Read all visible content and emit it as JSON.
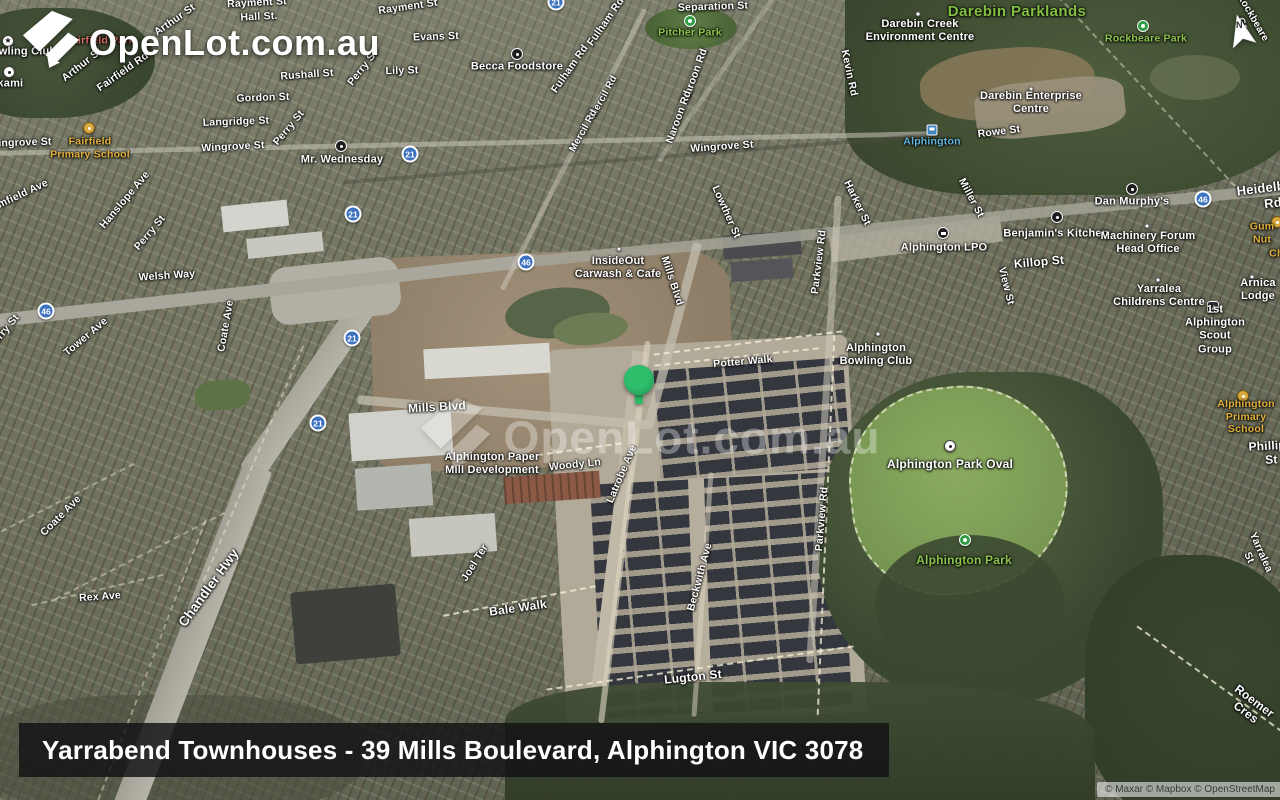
{
  "brand": {
    "logo_text": "OpenLot.com.au"
  },
  "watermark": {
    "text": "OpenLot.com.au"
  },
  "caption": {
    "text": "Yarrabend Townhouses - 39 Mills Boulevard, Alphington VIC 3078"
  },
  "attribution": {
    "text": "© Maxar © Mapbox © OpenStreetMap"
  },
  "compass": {
    "letter": "N"
  },
  "marker": {
    "label": "property-location",
    "x": 640,
    "y": 380,
    "color": "#2ebd6b"
  },
  "colors": {
    "shield_blue": "#3c72bf",
    "park_label_green": "#8cc44c",
    "school_label_amber": "#e3b23e",
    "station_label_blue": "#63b5e0",
    "area_label_red": "#e2756b",
    "pin_green": "#2ebd6b"
  },
  "map": {
    "shields": [
      {
        "n": "21",
        "x": 556,
        "y": 2
      },
      {
        "n": "21",
        "x": 410,
        "y": 154
      },
      {
        "n": "21",
        "x": 353,
        "y": 214
      },
      {
        "n": "21",
        "x": 352,
        "y": 338
      },
      {
        "n": "21",
        "x": 318,
        "y": 423
      },
      {
        "n": "46",
        "x": 46,
        "y": 311
      },
      {
        "n": "46",
        "x": 526,
        "y": 262
      },
      {
        "n": "46",
        "x": 1203,
        "y": 199
      }
    ],
    "markers": [
      {
        "type": "park",
        "x": 690,
        "y": 21
      },
      {
        "type": "park",
        "x": 1143,
        "y": 26
      },
      {
        "type": "park",
        "x": 965,
        "y": 540
      },
      {
        "type": "school",
        "x": 89,
        "y": 128
      },
      {
        "type": "school",
        "x": 1243,
        "y": 396
      },
      {
        "type": "school",
        "x": 1277,
        "y": 222
      },
      {
        "type": "poi-black",
        "x": 517,
        "y": 54
      },
      {
        "type": "poi-black",
        "x": 341,
        "y": 146
      },
      {
        "type": "poi-black",
        "x": 1132,
        "y": 189
      },
      {
        "type": "poi-black",
        "x": 1057,
        "y": 217
      },
      {
        "type": "poi-post",
        "x": 943,
        "y": 233
      },
      {
        "type": "dot",
        "x": 619,
        "y": 249
      },
      {
        "type": "star",
        "x": 8,
        "y": 41
      },
      {
        "type": "poi-white",
        "x": 9,
        "y": 72
      },
      {
        "type": "dot",
        "x": 918,
        "y": 14
      },
      {
        "type": "dot",
        "x": 1031,
        "y": 89
      },
      {
        "type": "dot",
        "x": 1147,
        "y": 226
      },
      {
        "type": "dot",
        "x": 1158,
        "y": 280
      },
      {
        "type": "dot",
        "x": 1252,
        "y": 277
      },
      {
        "type": "dot",
        "x": 878,
        "y": 334
      },
      {
        "type": "rail",
        "x": 932,
        "y": 130
      },
      {
        "type": "scout",
        "x": 1213,
        "y": 307
      },
      {
        "type": "poi-white",
        "x": 950,
        "y": 446
      }
    ],
    "labels": [
      {
        "t": "Rayment St",
        "x": 257,
        "y": 3,
        "r": -3
      },
      {
        "t": "Hall St.",
        "x": 259,
        "y": 17,
        "r": -3
      },
      {
        "t": "Rayment St",
        "x": 408,
        "y": 7,
        "r": -8
      },
      {
        "t": "Evans St",
        "x": 436,
        "y": 37,
        "r": -2
      },
      {
        "t": "Lily St",
        "x": 402,
        "y": 71,
        "r": -2
      },
      {
        "t": "Rushall St",
        "x": 307,
        "y": 75,
        "r": -4
      },
      {
        "t": "Perry St",
        "x": 363,
        "y": 68,
        "r": -52
      },
      {
        "t": "Arthur St",
        "x": 175,
        "y": 20,
        "r": -35
      },
      {
        "t": "Arthur St",
        "x": 82,
        "y": 65,
        "r": -38
      },
      {
        "t": "Fairfield Rd",
        "x": 123,
        "y": 72,
        "r": -35
      },
      {
        "t": "Separation St",
        "x": 713,
        "y": 7,
        "r": -2
      },
      {
        "t": "Gordon St",
        "x": 263,
        "y": 98,
        "r": -2
      },
      {
        "t": "Langridge St",
        "x": 236,
        "y": 122,
        "r": -2
      },
      {
        "t": "Wingrove St",
        "x": 20,
        "y": 143,
        "r": -2
      },
      {
        "t": "Wingrove St",
        "x": 233,
        "y": 147,
        "r": -3
      },
      {
        "t": "Wingrove St",
        "x": 722,
        "y": 147,
        "r": -4
      },
      {
        "t": "mfield Ave",
        "x": 23,
        "y": 194,
        "r": -25
      },
      {
        "t": "Hanslope Ave",
        "x": 125,
        "y": 200,
        "r": -50
      },
      {
        "t": "Perry St",
        "x": 150,
        "y": 233,
        "r": -50
      },
      {
        "t": "Perry St",
        "x": 289,
        "y": 128,
        "r": -50
      },
      {
        "t": "Welsh Way",
        "x": 167,
        "y": 276,
        "r": -4
      },
      {
        "t": "Fulham Rd",
        "x": 606,
        "y": 22,
        "r": -55
      },
      {
        "t": "Fulham Rd",
        "x": 570,
        "y": 69,
        "r": -55
      },
      {
        "t": "Mercil Rd",
        "x": 604,
        "y": 97,
        "r": -61,
        "s": 10
      },
      {
        "t": "Mercil Rd",
        "x": 584,
        "y": 131,
        "r": -61,
        "s": 10
      },
      {
        "t": "Naroon Rd",
        "x": 695,
        "y": 75,
        "r": -70
      },
      {
        "t": "Naroon Rd",
        "x": 679,
        "y": 117,
        "r": -70
      },
      {
        "t": "Kevin Rd",
        "x": 849,
        "y": 73,
        "r": 78
      },
      {
        "t": "Harker St",
        "x": 857,
        "y": 203,
        "r": 64
      },
      {
        "t": "Lowther St",
        "x": 726,
        "y": 212,
        "r": 66
      },
      {
        "t": "Miller St",
        "x": 971,
        "y": 198,
        "r": 62
      },
      {
        "t": "Rowe St",
        "x": 999,
        "y": 132,
        "r": -7
      },
      {
        "t": "Killop St",
        "x": 1039,
        "y": 262,
        "r": -5,
        "s": 12
      },
      {
        "t": "View St",
        "x": 1006,
        "y": 286,
        "r": 76
      },
      {
        "t": "Heidelberg Rd",
        "x": 1272,
        "y": 195,
        "r": -7,
        "s": 13
      },
      {
        "t": "Parkview Rd",
        "x": 819,
        "y": 262,
        "r": -83
      },
      {
        "t": "Parkview Rd",
        "x": 822,
        "y": 519,
        "r": -85
      },
      {
        "t": "Potter Walk",
        "x": 743,
        "y": 362,
        "r": -5
      },
      {
        "t": "Mills Blvd",
        "x": 437,
        "y": 407,
        "r": -3,
        "s": 12
      },
      {
        "t": "Mills Blvd",
        "x": 672,
        "y": 281,
        "r": 72
      },
      {
        "t": "Woody Ln",
        "x": 575,
        "y": 465,
        "r": -6
      },
      {
        "t": "Latrobe Ave",
        "x": 622,
        "y": 474,
        "r": -67
      },
      {
        "t": "Joel Ter",
        "x": 475,
        "y": 563,
        "r": -58
      },
      {
        "t": "Bale Walk",
        "x": 518,
        "y": 608,
        "r": -8,
        "s": 12
      },
      {
        "t": "Beckwith Ave",
        "x": 700,
        "y": 577,
        "r": -75
      },
      {
        "t": "Lugton St",
        "x": 693,
        "y": 677,
        "r": -6,
        "s": 12
      },
      {
        "t": "Coate Ave",
        "x": 226,
        "y": 326,
        "r": -80
      },
      {
        "t": "Tower Ave",
        "x": 86,
        "y": 337,
        "r": -40
      },
      {
        "t": "Coate Ave",
        "x": 61,
        "y": 516,
        "r": -45
      },
      {
        "t": "Rex Ave",
        "x": 100,
        "y": 597,
        "r": -4
      },
      {
        "t": "Chandler Hwy",
        "x": 209,
        "y": 588,
        "r": -54,
        "s": 13.5
      },
      {
        "t": "Perry St",
        "x": 4,
        "y": 332,
        "r": -50
      },
      {
        "t": "Phillips St",
        "x": 1271,
        "y": 453,
        "r": -3,
        "s": 12
      },
      {
        "t": "Yarralea St",
        "x": 1255,
        "y": 555,
        "r": 66
      },
      {
        "t": "Roemer Cres",
        "x": 1250,
        "y": 707,
        "r": 37,
        "s": 12
      },
      {
        "t": "Rockbeare Gr",
        "x": 1247,
        "y": 21,
        "r": 60,
        "s": 10
      },
      {
        "t": "Pitcher Park",
        "x": 690,
        "y": 33,
        "c": "park"
      },
      {
        "t": "Darebin Parklands",
        "x": 1017,
        "y": 12,
        "c": "park-lg"
      },
      {
        "t": "Rockbeare Park",
        "x": 1146,
        "y": 39,
        "c": "park"
      },
      {
        "t": "Alphington Park",
        "x": 964,
        "y": 560,
        "c": "park",
        "s": 12
      },
      {
        "t": "Fairfield Park",
        "x": 100,
        "y": 41,
        "c": "area"
      },
      {
        "t": "Fairfield\nPrimary School",
        "x": 90,
        "y": 148,
        "c": "school"
      },
      {
        "t": "Alphington\nPrimary School",
        "x": 1246,
        "y": 417,
        "c": "school"
      },
      {
        "t": "Gum Nut",
        "x": 1262,
        "y": 233,
        "c": "school"
      },
      {
        "t": "& Childcare",
        "x": 1294,
        "y": 247,
        "c": "school"
      },
      {
        "t": "Bowling Club",
        "x": 20,
        "y": 52,
        "c": "poi"
      },
      {
        "t": "Okami",
        "x": 6,
        "y": 84,
        "c": "poi"
      },
      {
        "t": "Becca Foodstore",
        "x": 517,
        "y": 67,
        "c": "poi"
      },
      {
        "t": "Mr. Wednesday",
        "x": 342,
        "y": 160,
        "c": "poi"
      },
      {
        "t": "Darebin Creek\nEnvironment Centre",
        "x": 920,
        "y": 31,
        "c": "poi"
      },
      {
        "t": "Darebin Enterprise\nCentre",
        "x": 1031,
        "y": 103,
        "c": "poi"
      },
      {
        "t": "Dan Murphy's",
        "x": 1132,
        "y": 202,
        "c": "poi"
      },
      {
        "t": "Benjamin's Kitchen",
        "x": 1056,
        "y": 234,
        "c": "poi"
      },
      {
        "t": "Machinery Forum\nHead Office",
        "x": 1148,
        "y": 243,
        "c": "poi"
      },
      {
        "t": "Alphington LPO",
        "x": 944,
        "y": 248,
        "c": "poi"
      },
      {
        "t": "Yarralea\nChildrens Centre",
        "x": 1159,
        "y": 296,
        "c": "poi"
      },
      {
        "t": "Arnica Lodge",
        "x": 1258,
        "y": 290,
        "c": "poi"
      },
      {
        "t": "1st Alphington\nScout Group",
        "x": 1215,
        "y": 330,
        "c": "poi"
      },
      {
        "t": "InsideOut\nCarwash & Cafe",
        "x": 618,
        "y": 268,
        "c": "poi"
      },
      {
        "t": "Alphington\nBowling Club",
        "x": 876,
        "y": 355,
        "c": "poi"
      },
      {
        "t": "Alphington Paper\nMill Development",
        "x": 492,
        "y": 464,
        "c": "poi"
      },
      {
        "t": "Alphington Park Oval",
        "x": 950,
        "y": 464,
        "c": "poi",
        "s": 12
      },
      {
        "t": "Alphington",
        "x": 932,
        "y": 142,
        "c": "station"
      }
    ]
  }
}
